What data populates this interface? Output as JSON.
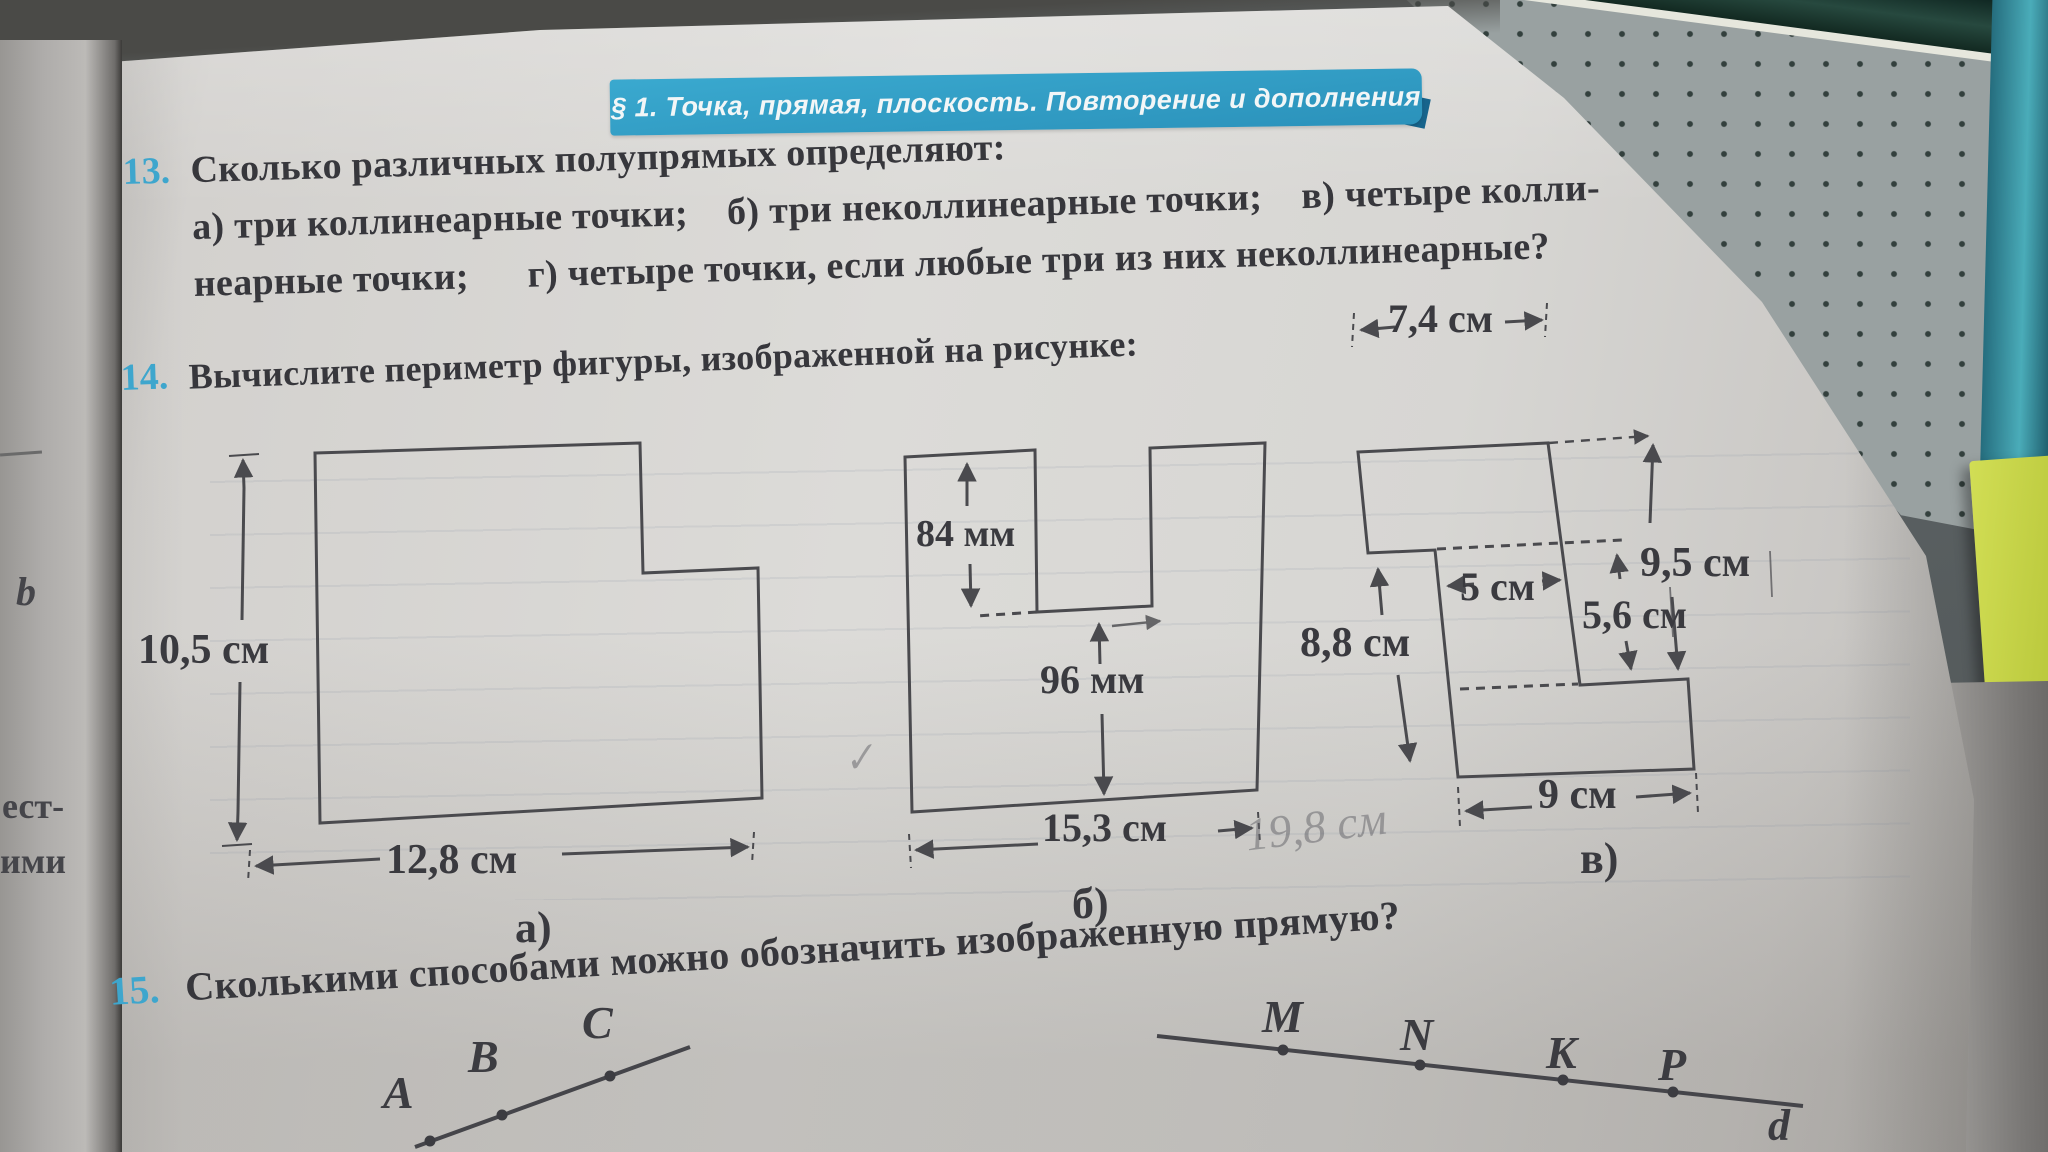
{
  "banner": {
    "title": "§ 1. Точка, прямая, плоскость. Повторение и дополнения"
  },
  "problem13": {
    "number": "13.",
    "line1": "Сколько различных полупрямых определяют:",
    "line2": "а) три коллинеарные точки;    б) три неколлинеарные точки;    в) четыре колли-",
    "line3": "неарные точки;      г) четыре точки, если любые три из них неколлинеарные?"
  },
  "problem14": {
    "number": "14.",
    "title": "Вычислите периметр фигуры, изображенной на рисунке:"
  },
  "problem15": {
    "number": "15.",
    "title": "Сколькими способами можно обозначить изображенную прямую?"
  },
  "figure_a": {
    "label": "а)",
    "height": "10,5 см",
    "width": "12,8 см"
  },
  "figure_b": {
    "label": "б)",
    "notch_depth": "84 мм",
    "inner_height": "96 мм",
    "width": "15,3 см"
  },
  "figure_v": {
    "label": "в)",
    "top_width": "7,4 см",
    "right_height": "9,5 см",
    "inner_width": "5 см",
    "step_height": "5,6 см",
    "left_height": "8,8 см",
    "bottom_width": "9 см"
  },
  "line_abc": {
    "points": [
      "A",
      "B",
      "C"
    ]
  },
  "line_mnkp": {
    "points": [
      "M",
      "N",
      "K",
      "P"
    ],
    "line_label": "d"
  },
  "margin": {
    "fragment1": "ест-",
    "fragment2": "ими",
    "fragment3": "b"
  },
  "handwriting": {
    "note": "19,8 см",
    "tick": "✓"
  }
}
